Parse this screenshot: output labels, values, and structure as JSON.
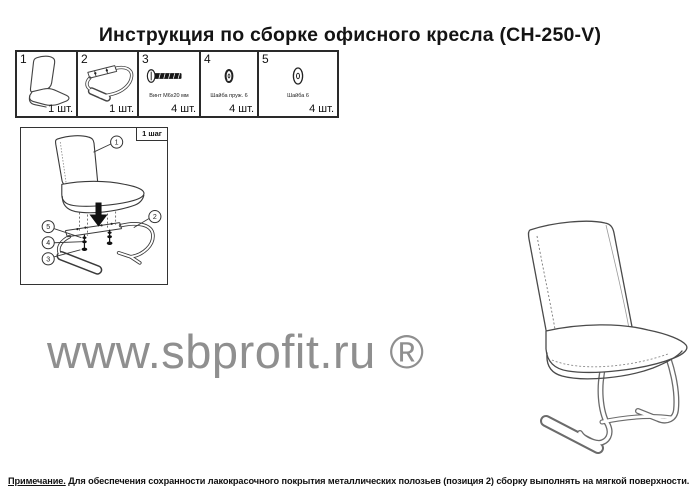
{
  "title": "Инструкция по сборке офисного кресла (CH-250-V)",
  "parts_table": {
    "cells": [
      {
        "num": "1",
        "label": "",
        "qty": "1 шт.",
        "icon": "seat-back-part-icon"
      },
      {
        "num": "2",
        "label": "",
        "qty": "1 шт.",
        "icon": "base-frame-part-icon"
      },
      {
        "num": "3",
        "label": "Винт М6х20 мм",
        "qty": "4 шт.",
        "icon": "screw-icon"
      },
      {
        "num": "4",
        "label": "Шайба пруж. 6",
        "qty": "4 шт.",
        "icon": "spring-washer-icon"
      },
      {
        "num": "5",
        "label": "Шайба 6",
        "qty": "4 шт.",
        "icon": "flat-washer-icon"
      }
    ]
  },
  "assembly": {
    "step_label": "1 шаг",
    "callouts": [
      "1",
      "2",
      "3",
      "4",
      "5"
    ]
  },
  "watermark": {
    "text": "www.sbprofit.ru ®",
    "color": "#8f8f8f"
  },
  "note": {
    "lead": "Примечание.",
    "body": " Для обеспечения сохранности лакокрасочного покрытия металлических полозьев (позиция 2) сборку выполнять на мягкой поверхности."
  },
  "icons": {
    "part_1": "seat-back-drawing",
    "part_2": "cantilever-base-drawing",
    "part_3": "screw-side-view",
    "part_4": "spring-washer",
    "part_5": "flat-washer",
    "assembly_arrow": "down-arrow",
    "right_figure": "assembled-chair-line-drawing"
  }
}
